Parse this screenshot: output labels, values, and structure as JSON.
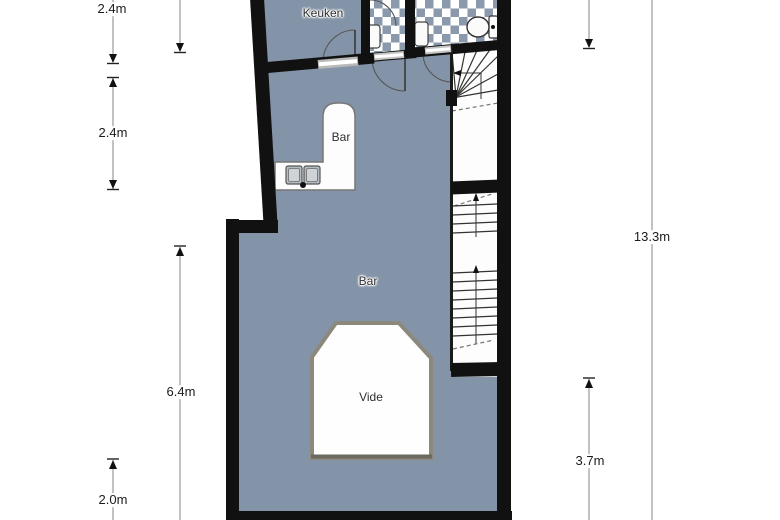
{
  "plan": {
    "rooms": [
      {
        "id": "kitchen",
        "label": "Keuken"
      },
      {
        "id": "bar-counter",
        "label": "Bar"
      },
      {
        "id": "bar-room",
        "label": "Bar"
      },
      {
        "id": "vide",
        "label": "Vide"
      }
    ],
    "dimensions": [
      {
        "id": "dim-left-top",
        "label": "2.4m"
      },
      {
        "id": "dim-left-middle",
        "label": "2.4m"
      },
      {
        "id": "dim-left-inner",
        "label": "6.4m"
      },
      {
        "id": "dim-left-bottom",
        "label": "2.0m"
      },
      {
        "id": "dim-right-total",
        "label": "13.3m"
      },
      {
        "id": "dim-right-lower",
        "label": "3.7m"
      }
    ],
    "colors": {
      "floor": "#8494a8",
      "wall": "#111111",
      "tile_accent": "#8b99ac",
      "stair_fill": "#fdfdfd",
      "vide_border": "#8c887c",
      "dimension_line": "#9a9a9a"
    }
  }
}
